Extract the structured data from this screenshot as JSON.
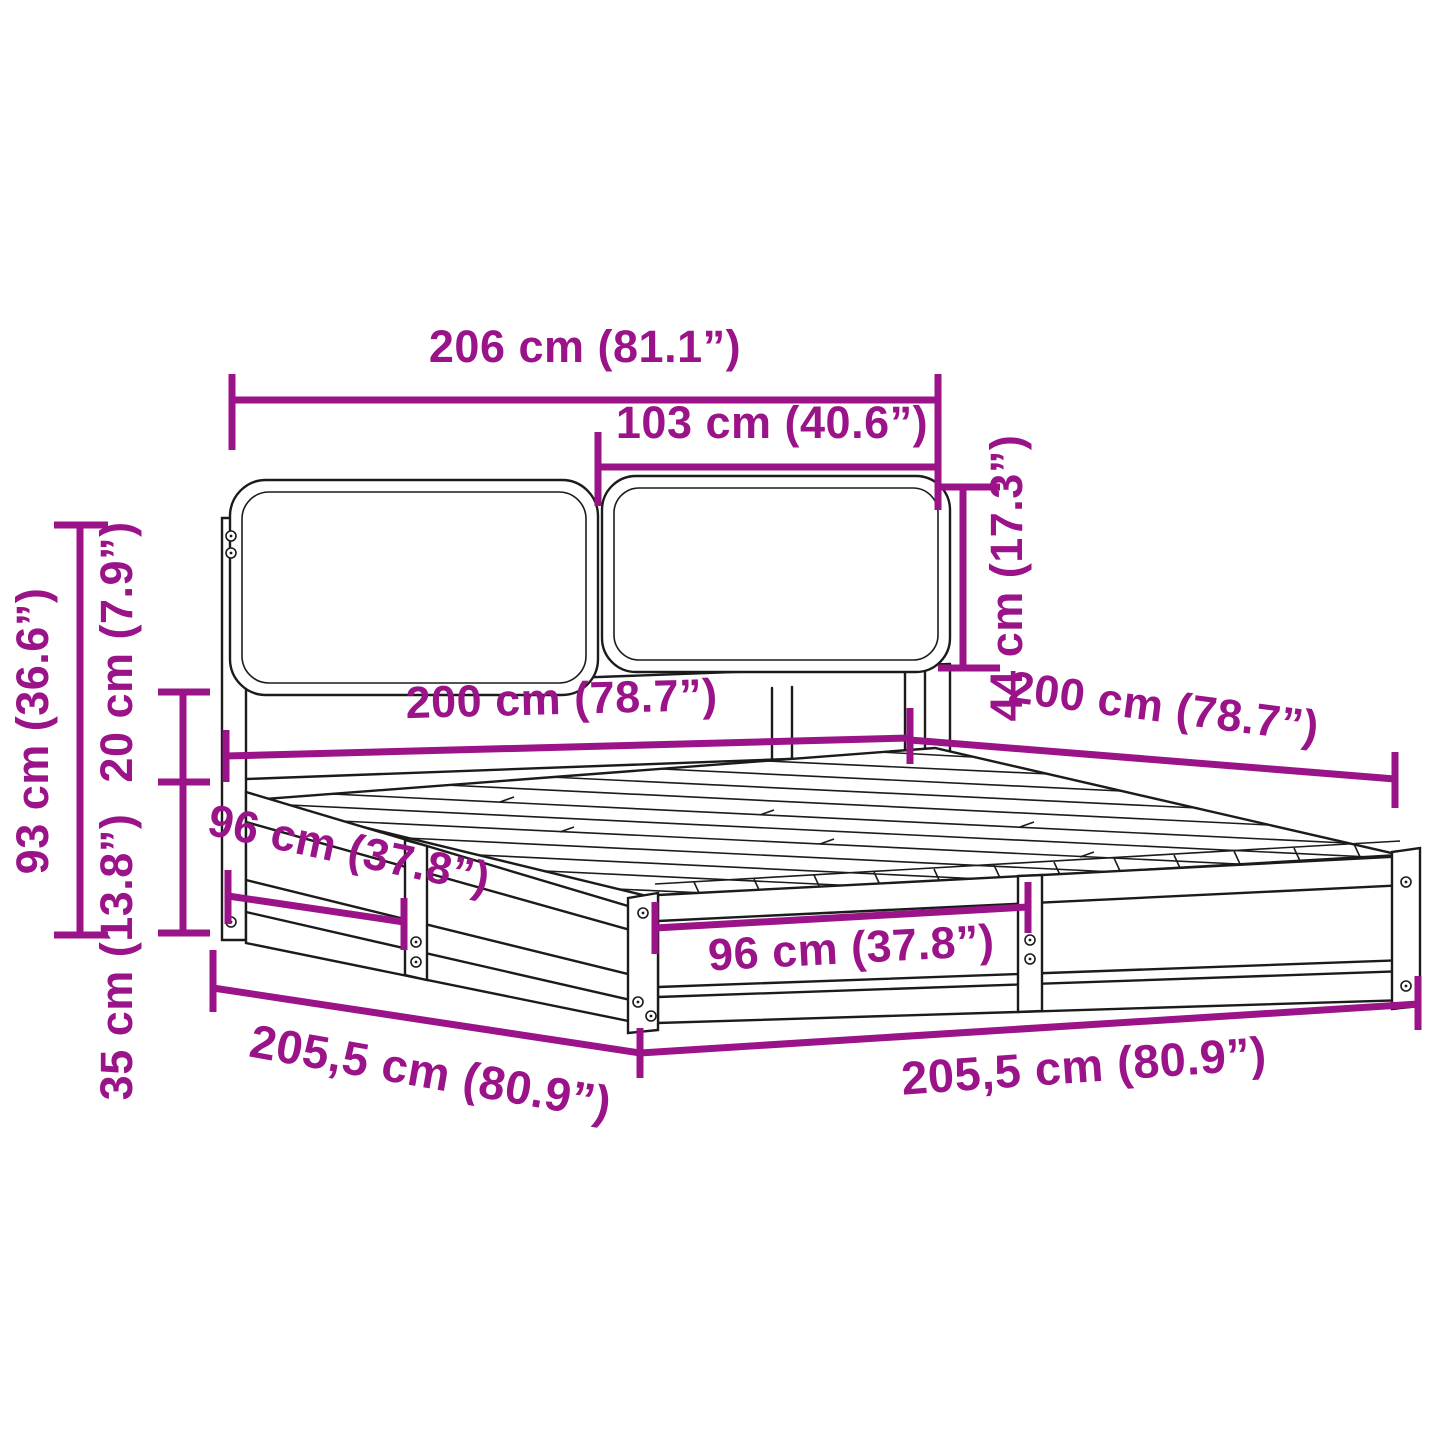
{
  "meta": {
    "title": "Bed frame dimension diagram"
  },
  "colors": {
    "accent": "#9A1388",
    "line": "#1b1b1b",
    "background": "#ffffff"
  },
  "dims": {
    "width_total": "206 cm (81.1”)",
    "cushion_width": "103 cm (40.6”)",
    "cushion_height": "44 cm (17.3”)",
    "headboard_height": "93 cm (36.6”)",
    "gap_height": "20 cm (7.9”)",
    "base_height": "35 cm (13.8”)",
    "bed_width": "200 cm (78.7”)",
    "bed_length": "200 cm (78.7”)",
    "side_section": "96 cm (37.8”)",
    "foot_section": "96 cm (37.8”)",
    "outer_length": "205,5 cm (80.9”)",
    "outer_width": "205,5 cm (80.9”)"
  }
}
